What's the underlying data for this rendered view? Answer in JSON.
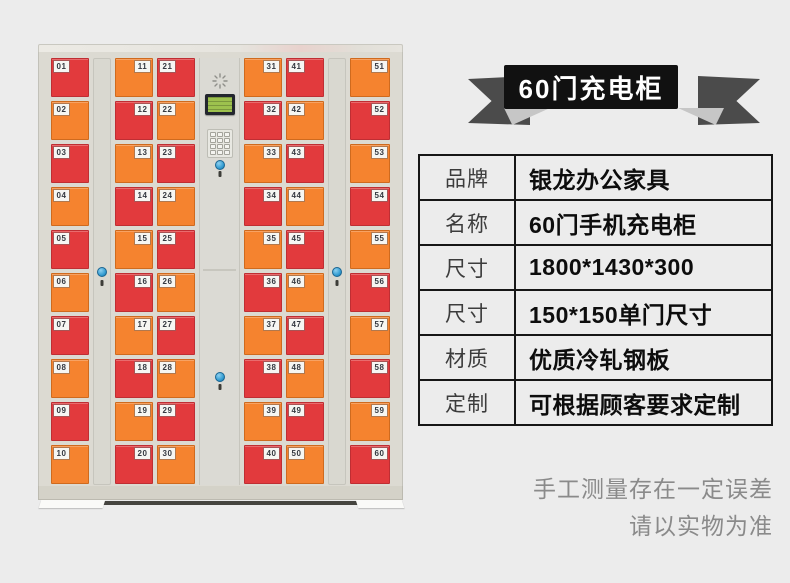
{
  "banner": {
    "title": "60门充电柜"
  },
  "spec_table": {
    "rows": [
      {
        "label": "品牌",
        "value": "银龙办公家具"
      },
      {
        "label": "名称",
        "value": "60门手机充电柜"
      },
      {
        "label": "尺寸",
        "value": "1800*1430*300"
      },
      {
        "label": "尺寸",
        "value": "150*150单门尺寸"
      },
      {
        "label": "材质",
        "value": "优质冷轧钢板"
      },
      {
        "label": "定制",
        "value": "可根据顾客要求定制"
      }
    ]
  },
  "disclaimer": {
    "line1": "手工测量存在一定误差",
    "line2": "请以实物为准"
  },
  "colors": {
    "background": "#ececec",
    "banner_bg": "#111111",
    "ribbon_wing": "#4b4b4b",
    "ribbon_fold": "#c6c6c6",
    "table_border": "#161616",
    "disclaimer_gray": "#8a8a8a",
    "cabinet_frame": "#dcdad2",
    "lock_blue": "#2f9ad0",
    "lcd_green": "#9dc14e"
  },
  "icons": {
    "speaker-grille": "radial-dashes",
    "lock": "blue-circle-cylinder",
    "keyhole": "dark-slot",
    "lcd-screen": "green-display",
    "keypad": "3x4-button-grid"
  },
  "cabinet": {
    "door_colors": {
      "red": "#e23a3d",
      "orange": "#f5832f"
    },
    "layout": [
      "doors-0",
      "panel",
      "doors-1",
      "doors-2",
      "control",
      "doors-3",
      "doors-4",
      "panel",
      "doors-5"
    ],
    "columns": [
      {
        "label_side": "left",
        "doors": [
          {
            "n": "01",
            "c": "red"
          },
          {
            "n": "02",
            "c": "orange"
          },
          {
            "n": "03",
            "c": "red"
          },
          {
            "n": "04",
            "c": "orange"
          },
          {
            "n": "05",
            "c": "red"
          },
          {
            "n": "06",
            "c": "orange"
          },
          {
            "n": "07",
            "c": "red"
          },
          {
            "n": "08",
            "c": "orange"
          },
          {
            "n": "09",
            "c": "red"
          },
          {
            "n": "10",
            "c": "orange"
          }
        ]
      },
      {
        "label_side": "right",
        "doors": [
          {
            "n": "11",
            "c": "orange"
          },
          {
            "n": "12",
            "c": "red"
          },
          {
            "n": "13",
            "c": "orange"
          },
          {
            "n": "14",
            "c": "red"
          },
          {
            "n": "15",
            "c": "orange"
          },
          {
            "n": "16",
            "c": "red"
          },
          {
            "n": "17",
            "c": "orange"
          },
          {
            "n": "18",
            "c": "red"
          },
          {
            "n": "19",
            "c": "orange"
          },
          {
            "n": "20",
            "c": "red"
          }
        ]
      },
      {
        "label_side": "left",
        "doors": [
          {
            "n": "21",
            "c": "red"
          },
          {
            "n": "22",
            "c": "orange"
          },
          {
            "n": "23",
            "c": "red"
          },
          {
            "n": "24",
            "c": "orange"
          },
          {
            "n": "25",
            "c": "red"
          },
          {
            "n": "26",
            "c": "orange"
          },
          {
            "n": "27",
            "c": "red"
          },
          {
            "n": "28",
            "c": "orange"
          },
          {
            "n": "29",
            "c": "red"
          },
          {
            "n": "30",
            "c": "orange"
          }
        ]
      },
      {
        "label_side": "right",
        "doors": [
          {
            "n": "31",
            "c": "orange"
          },
          {
            "n": "32",
            "c": "red"
          },
          {
            "n": "33",
            "c": "orange"
          },
          {
            "n": "34",
            "c": "red"
          },
          {
            "n": "35",
            "c": "orange"
          },
          {
            "n": "36",
            "c": "red"
          },
          {
            "n": "37",
            "c": "orange"
          },
          {
            "n": "38",
            "c": "red"
          },
          {
            "n": "39",
            "c": "orange"
          },
          {
            "n": "40",
            "c": "red"
          }
        ]
      },
      {
        "label_side": "left",
        "doors": [
          {
            "n": "41",
            "c": "red"
          },
          {
            "n": "42",
            "c": "orange"
          },
          {
            "n": "43",
            "c": "red"
          },
          {
            "n": "44",
            "c": "orange"
          },
          {
            "n": "45",
            "c": "red"
          },
          {
            "n": "46",
            "c": "orange"
          },
          {
            "n": "47",
            "c": "red"
          },
          {
            "n": "48",
            "c": "orange"
          },
          {
            "n": "49",
            "c": "red"
          },
          {
            "n": "50",
            "c": "orange"
          }
        ]
      },
      {
        "label_side": "right",
        "doors": [
          {
            "n": "51",
            "c": "orange"
          },
          {
            "n": "52",
            "c": "red"
          },
          {
            "n": "53",
            "c": "orange"
          },
          {
            "n": "54",
            "c": "red"
          },
          {
            "n": "55",
            "c": "orange"
          },
          {
            "n": "56",
            "c": "red"
          },
          {
            "n": "57",
            "c": "orange"
          },
          {
            "n": "58",
            "c": "red"
          },
          {
            "n": "59",
            "c": "orange"
          },
          {
            "n": "60",
            "c": "red"
          }
        ]
      }
    ]
  }
}
